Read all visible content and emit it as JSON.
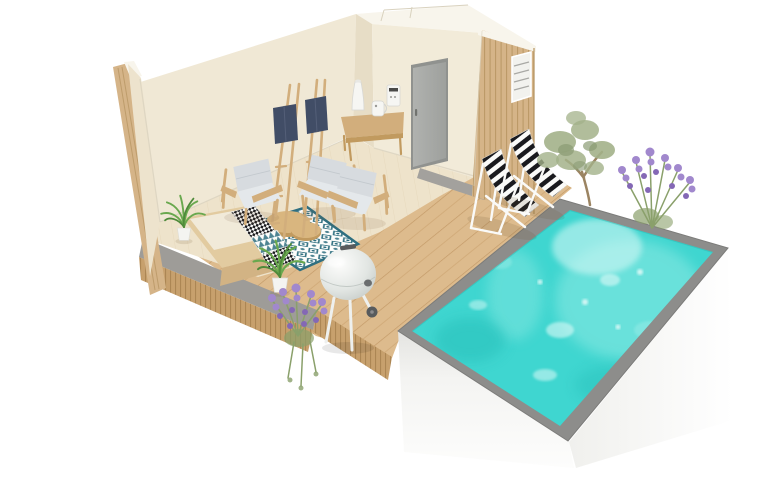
{
  "scene": {
    "type": "3d-architectural-render",
    "description": "Isometric cutaway 3D rendering of a pool-house lounge room opening onto a wooden deck with striped deck chairs, a kettle barbecue, plants and a raised turquoise swimming pool",
    "objects": [
      "pool-house room with cutaway beige walls",
      "timber slat exterior cladding",
      "grey interior door",
      "small vent window on slat wall",
      "two decorative wooden ladders with navy towels",
      "three wooden armchairs with grey cushions",
      "wooden bench with patterned cushions",
      "blue moroccan-pattern rug",
      "two round nesting coffee tables",
      "wooden desk with lamp and small appliances",
      "potted palm plants",
      "diagonal plank wooden deck",
      "two black-and-white striped deck chairs",
      "white kettle barbecue grill",
      "olive tree",
      "lavender bushes",
      "raised swimming pool with grey coping and white walls"
    ]
  },
  "colors": {
    "bg": "#ffffff",
    "wall": "#f0e8d5",
    "wall_left": "#ede3cd",
    "wall_front": "#f2ebd9",
    "wall_sliver": "#e7ddc6",
    "wall_top": "#f8f5ec",
    "wall_edge_line": "#d9d2bf",
    "door": "#a8aaa7",
    "door_frame": "#90928f",
    "door_handle": "#71736f",
    "slat_wood": "#d5b488",
    "slat_line": "#b3925f",
    "floor": "#eee3cb",
    "floor_line": "#c8ab7c",
    "deck": "#ddbb8d",
    "deck_line": "#a8763f",
    "concrete": "#9e9c98",
    "step": "#a3a19d",
    "fascia": "#c7a06d",
    "fascia_line": "#9a7440",
    "coping": "#8d8d8b",
    "water": "#3fd6d0",
    "ripple_light": "#94ebe5",
    "ripple_bright": "#dcf9f7",
    "ripple_dark": "#27bdb8",
    "pool_wall": "#f7f7f5",
    "pool_wall_shade": "#e9e9e6",
    "cushion": "#d7dbdf",
    "cushion_light": "#e4e8eb",
    "cushion_seam": "#c3c9ce",
    "frame_wood": "#d2ae7c",
    "wood_dark": "#c19a5f",
    "towel": "#414d66",
    "rug_blue": "#2f6f80",
    "rug_bg": "#fdfdfb",
    "stripe_black": "#1a1a1e",
    "stripe_white": "#fbfbf9",
    "palm_green": "#69a84e",
    "palm_green_dark": "#4e8a3a",
    "olive_green": "#a3b189",
    "olive_green_dark": "#8a9b74",
    "lavender": "#a188cd",
    "lavender_deep": "#8468b5",
    "stem_green": "#8aa06b",
    "grill_mid": "#d9dedb",
    "grill_dark": "#585b5d",
    "grill_leg": "#eef0ee",
    "bench_wood": "#e2cba0",
    "bench_wood_dark": "#d2b384",
    "table_wood": "#d9b67f",
    "pot_white": "#f4f4f1",
    "lamp_white": "#f6f6f3"
  }
}
